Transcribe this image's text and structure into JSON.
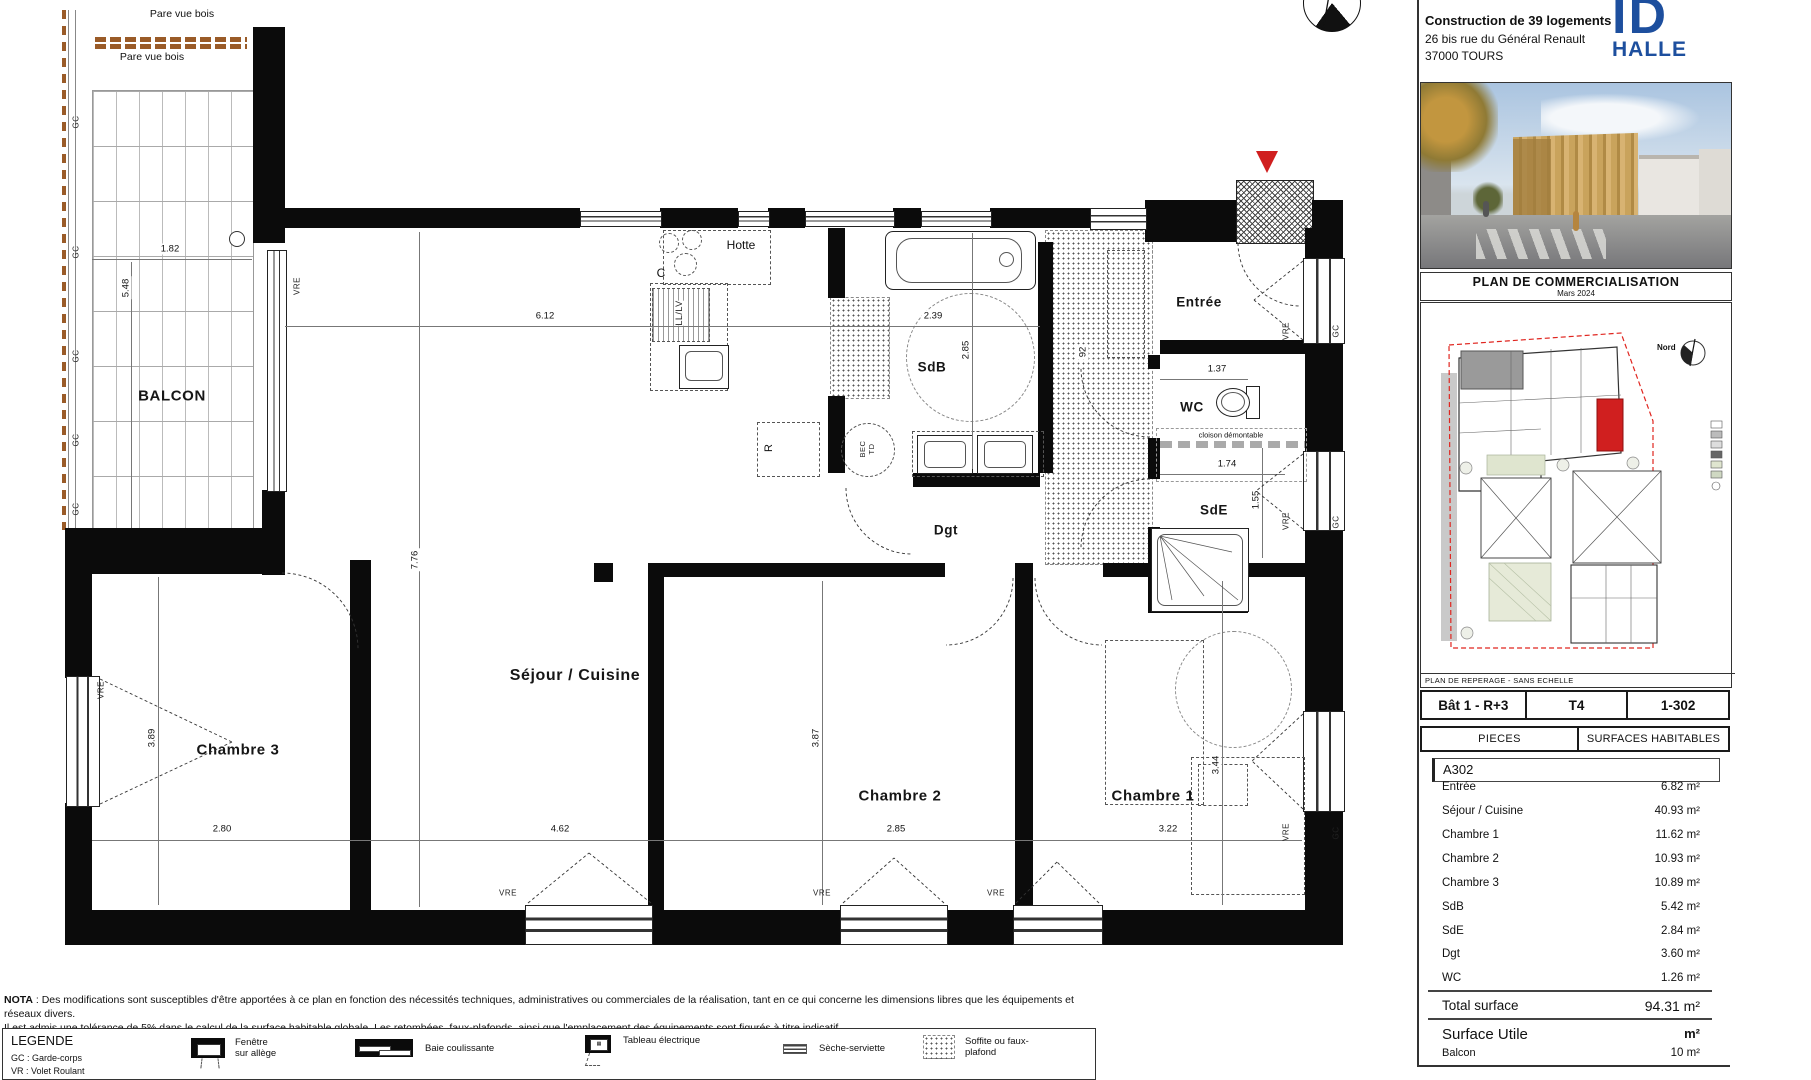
{
  "title_block": {
    "project_line1": "Construction de 39 logements",
    "project_line2": "26 bis rue du Général Renault",
    "project_line3": "37000 TOURS",
    "logo": {
      "top": "ID",
      "bottom": "HALLE",
      "color": "#1d4f9e"
    },
    "caption": {
      "title": "PLAN DE COMMERCIALISATION",
      "subtitle": "Mars 2024"
    },
    "site_plan": {
      "north_label": "Nord",
      "footer": "PLAN DE REPERAGE - SANS ECHELLE",
      "highlight_color": "#d01f1f"
    },
    "unit_strip": {
      "building": "Bât 1 - R+3",
      "type": "T4",
      "number": "1-302"
    },
    "surface_table": {
      "col_rooms": "PIECES",
      "col_surfaces": "SURFACES HABITABLES",
      "unit_code": "A302",
      "rows": [
        {
          "room": "Entrée",
          "surface": "6.82 m²"
        },
        {
          "room": "Séjour / Cuisine",
          "surface": "40.93 m²"
        },
        {
          "room": "Chambre 1",
          "surface": "11.62 m²"
        },
        {
          "room": "Chambre 2",
          "surface": "10.93 m²"
        },
        {
          "room": "Chambre 3",
          "surface": "10.89 m²"
        },
        {
          "room": "SdB",
          "surface": "5.42 m²"
        },
        {
          "room": "SdE",
          "surface": "2.84 m²"
        },
        {
          "room": "Dgt",
          "surface": "3.60 m²"
        },
        {
          "room": "WC",
          "surface": "1.26 m²"
        }
      ],
      "total_label": "Total surface",
      "total_value": "94.31 m²",
      "utile_label": "Surface Utile",
      "utile_value": "m²",
      "balcony_label": "Balcon",
      "balcony_value": "10 m²"
    }
  },
  "plan": {
    "rooms": {
      "balcon": "BALCON",
      "sejour": "Séjour / Cuisine",
      "chambre1": "Chambre 1",
      "chambre2": "Chambre 2",
      "chambre3": "Chambre 3",
      "sdb": "SdB",
      "sde": "SdE",
      "wc": "WC",
      "dgt": "Dgt",
      "entree": "Entrée"
    },
    "annotations": {
      "pare_vue": "Pare vue bois",
      "hotte": "Hotte",
      "cooktop": "C",
      "ll_lv": "LL/LV",
      "fridge": "R",
      "bec_td": "BEC TD",
      "cloison": "cloison démontable",
      "vre": "VRE",
      "gc": "GC"
    },
    "dims": {
      "balcon_w": "1.82",
      "balcon_h": "5.48",
      "sejour_w": "6.12",
      "sejour_h": "7.76",
      "sejour_w2": "4.62",
      "ch3_w": "2.80",
      "ch3_h": "3.89",
      "ch2_w": "2.85",
      "ch2_h": "3.87",
      "ch1_w": "3.22",
      "ch1_h": "3.44",
      "sdb_w": "2.39",
      "sdb_h": "2.85",
      "wc_w": "1.37",
      "wc_d": "92",
      "sde_w": "1.74",
      "sde_h": "1.55"
    }
  },
  "nota": {
    "label": "NOTA",
    "line1": " : Des modifications sont susceptibles d'être apportées à ce plan en fonction des nécessités techniques, administratives ou commerciales de la réalisation, tant en ce qui concerne les dimensions libres que les équipements et réseaux divers.",
    "line2": "Il est admis une tolérance de 5% dans le calcul de la surface habitable globale. Les retombées, faux-plafonds, ainsi que l'emplacement des équipements sont figurés à titre indicatif."
  },
  "legend": {
    "title": "LEGENDE",
    "abbr1": "GC : Garde-corps",
    "abbr2": "VR : Volet Roulant",
    "items": [
      {
        "label": "Fenêtre sur allège"
      },
      {
        "label": "Baie coulissante"
      },
      {
        "label": "Tableau électrique"
      },
      {
        "label": "Sèche-serviette"
      },
      {
        "label": "Soffite ou faux-plafond"
      }
    ]
  }
}
